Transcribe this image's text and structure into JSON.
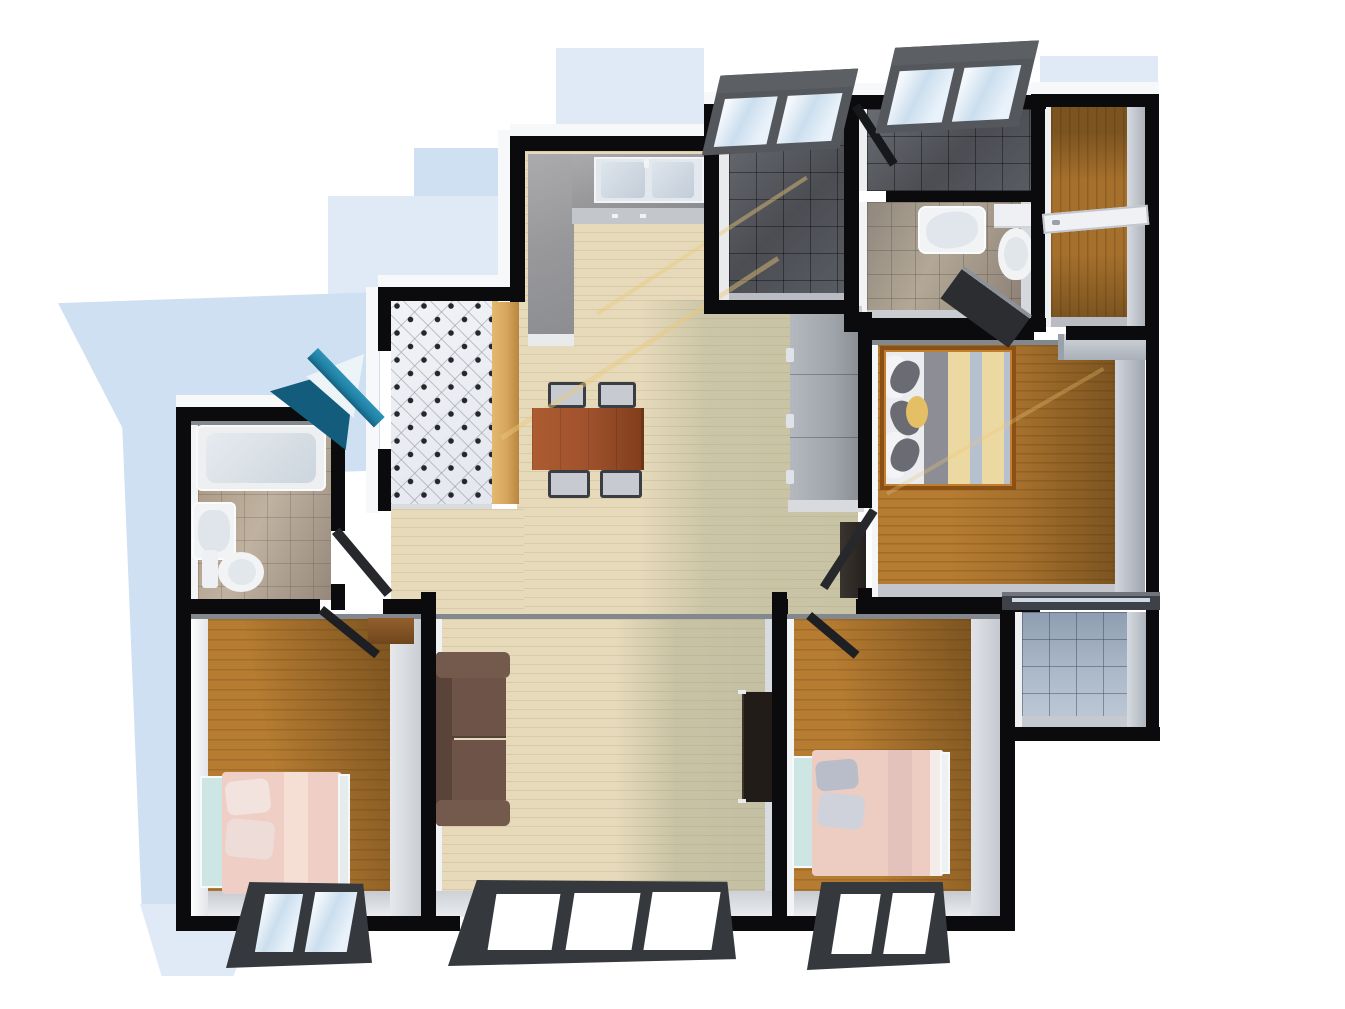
{
  "scene": {
    "kind": "3d-apartment-floorplan-render",
    "view": "top-down dollhouse",
    "rooms": [
      {
        "id": "entrance-hall",
        "label": "Entrance Hall",
        "floor": "white-diamond-tile",
        "features": [
          "blue-front-door",
          "tan-shoe-wardrobe"
        ]
      },
      {
        "id": "kitchen",
        "label": "Kitchen",
        "floor": "pale-wood",
        "features": [
          "l-shaped-granite-counter",
          "double-sink",
          "faucet"
        ]
      },
      {
        "id": "utility-room",
        "label": "Utility / Shower Room",
        "floor": "dark-grey-tile",
        "features": [
          "skylight-window",
          "dark-door"
        ]
      },
      {
        "id": "bathroom-2",
        "label": "Bathroom 2",
        "floor": "warm-grey-tile",
        "features": [
          "shower-strip",
          "wash-basin",
          "toilet",
          "dark-door",
          "skylight-window"
        ]
      },
      {
        "id": "corridor",
        "label": "Corridor / Closet",
        "floor": "wood",
        "features": [
          "white-door",
          "shelf"
        ]
      },
      {
        "id": "master-bedroom",
        "label": "Master Bedroom",
        "floor": "wood",
        "features": [
          "double-bed-striped-duvet",
          "closet-shelf",
          "balcony-slider",
          "dark-door"
        ]
      },
      {
        "id": "hallway",
        "label": "Hallway / Dining",
        "floor": "pale-wood",
        "features": [
          "dining-table",
          "four-chairs",
          "grey-wardrobe",
          "dark-cabinet"
        ]
      },
      {
        "id": "bathroom-1",
        "label": "Bathroom 1",
        "floor": "warm-tile",
        "features": [
          "bathtub",
          "wash-basin",
          "toilet",
          "dark-door"
        ]
      },
      {
        "id": "bedroom-left",
        "label": "Bedroom (bottom-left)",
        "floor": "wood",
        "features": [
          "single-bed-pink",
          "desk",
          "window"
        ]
      },
      {
        "id": "living-room",
        "label": "Living Room",
        "floor": "pale-wood",
        "features": [
          "brown-sofa",
          "tv-stand",
          "triple-window"
        ]
      },
      {
        "id": "bedroom-right",
        "label": "Bedroom (bottom-right)",
        "floor": "wood",
        "features": [
          "single-bed-pink",
          "window"
        ]
      },
      {
        "id": "balcony",
        "label": "Balcony",
        "floor": "blue-grey-tile",
        "features": [
          "sliding-window-track"
        ]
      }
    ],
    "window_count": {
      "bottom": 3,
      "skylights": 2
    },
    "palette": {
      "wall": "#0b0b0d",
      "wallFace": "#f7f8fa",
      "wallInnerShadow": "#83878e",
      "paleWood": "#e6dabb",
      "paleWoodLit": "#f3e8c9",
      "wood": "#a5702c",
      "woodLit": "#b67c31",
      "woodShade": "#7c5420",
      "tileDark": "#4b4d53",
      "tileWarm": "#b3a896",
      "tileBath": "#c0b2a0",
      "tileBalcony": "#aab8c8",
      "counter": "#9a9a9d",
      "sofa": "#6e5448",
      "sofaDark": "#5a4339",
      "table": "#a0522d",
      "tvStand": "#221c19",
      "bedPink": "#efcfc5",
      "headboard": "#cde6e4",
      "duvetGrey": "#8d8d95",
      "duvetCream": "#ecd9a2",
      "duvetBlue": "#b7c0cf",
      "pillowGrey": "#6b6b73",
      "pillowYellow": "#e4bf66",
      "doorDark": "#26282c",
      "doorBlue": "#1f7fa3",
      "doorBlueDark": "#135c7c",
      "doorWhite": "#eff1f4",
      "windowFrame": "#35383d",
      "skyFrame": "#54575c",
      "glass": "#cbdeee",
      "shadowBlue": "#cfe0f2",
      "shadowBlueLight": "#e0eaf7",
      "wardrobeTan": "#d6a55e",
      "wardrobeGrey": "#9ea4aa",
      "fixtureWhite": "#f1f3f5"
    }
  }
}
